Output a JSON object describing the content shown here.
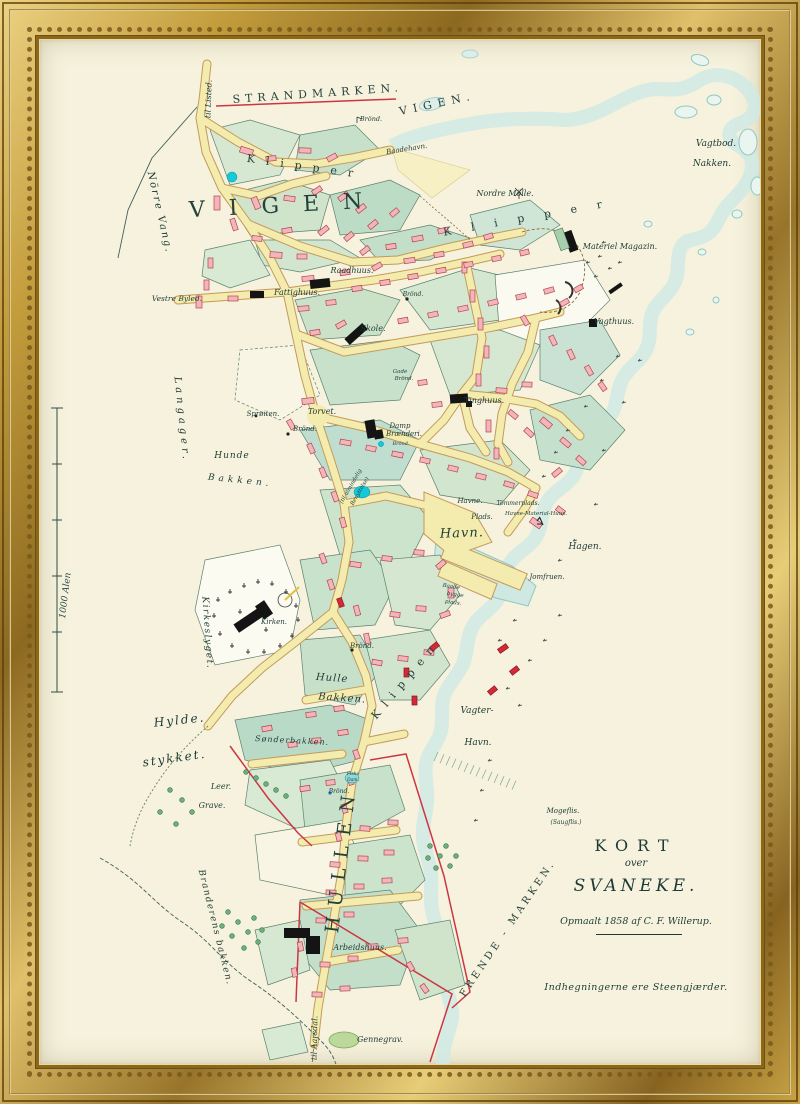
{
  "artwork": {
    "kind": "framed antique town map",
    "colors": {
      "frame_gold": "#c9a344",
      "paper": "#f6f2dd",
      "water": "#8fc9c3",
      "road_yellow": "#f3ecae",
      "parcel_green": "#cfe4cb",
      "building_pink": "#f2b6ba",
      "boundary_red": "#cc3644",
      "ink": "#1d3a35"
    },
    "title_block": {
      "kort": "KORT",
      "over": "over",
      "svaneke": "SVANEKE.",
      "surveyed": "Opmaalt 1858 af C. F. Willerup.",
      "note": "Indhegningerne ere Steengjærder."
    },
    "scale_bar": {
      "label": "1000 Alen"
    },
    "labels": [
      {
        "t": "STRANDMARKEN.",
        "x": 318,
        "y": 97,
        "r": -4,
        "s": 11,
        "sp": 5,
        "c": "a"
      },
      {
        "t": "Klipper",
        "x": 305,
        "y": 170,
        "r": 8,
        "s": 11,
        "sp": 11,
        "c": "a"
      },
      {
        "t": "VIGEN.",
        "x": 438,
        "y": 107,
        "r": -12,
        "s": 11,
        "sp": 6,
        "c": "a"
      },
      {
        "t": "VIGEN",
        "x": 288,
        "y": 212,
        "r": -3,
        "s": 22,
        "sp": 24,
        "c": "a"
      },
      {
        "t": "Klipper",
        "x": 533,
        "y": 220,
        "r": -10,
        "s": 11,
        "sp": 20,
        "c": "a"
      },
      {
        "t": "Klippen",
        "x": 408,
        "y": 682,
        "r": -50,
        "s": 11,
        "sp": 8,
        "c": "a"
      },
      {
        "t": "FRENDE - MARKEN.",
        "x": 510,
        "y": 930,
        "r": -56,
        "s": 10,
        "sp": 3.5,
        "c": "a"
      },
      {
        "t": "HULLEN",
        "x": 347,
        "y": 860,
        "r": -83,
        "s": 19,
        "sp": 10,
        "c": "a"
      },
      {
        "t": "Hylde.",
        "x": 180,
        "y": 724,
        "r": -6,
        "s": 12,
        "sp": 2,
        "c": "b"
      },
      {
        "t": "stykket.",
        "x": 175,
        "y": 762,
        "r": -8,
        "s": 12,
        "sp": 2,
        "c": "b"
      },
      {
        "t": "Nörre Vang.",
        "x": 157,
        "y": 213,
        "r": 77,
        "s": 10,
        "sp": 2,
        "c": "b"
      },
      {
        "t": "Langager.",
        "x": 179,
        "y": 420,
        "r": 84,
        "s": 10,
        "sp": 4,
        "c": "b"
      },
      {
        "t": "Kirkeslyget.",
        "x": 205,
        "y": 633,
        "r": 86,
        "s": 9,
        "sp": 1.5,
        "c": "b"
      },
      {
        "t": "Branderens bakken.",
        "x": 213,
        "y": 928,
        "r": 76,
        "s": 9,
        "sp": 1.5,
        "c": "b"
      },
      {
        "t": "til Listed.",
        "x": 211,
        "y": 99,
        "r": -88,
        "s": 8,
        "sp": 0,
        "c": "b"
      },
      {
        "t": "til Aarsdal.",
        "x": 317,
        "y": 1038,
        "r": -89,
        "s": 8,
        "sp": 0,
        "c": "b"
      },
      {
        "t": "Hunde",
        "x": 232,
        "y": 458,
        "r": 0,
        "s": 9,
        "sp": 1,
        "c": "b"
      },
      {
        "t": "Bakken.",
        "x": 240,
        "y": 483,
        "r": 6,
        "s": 9,
        "sp": 4,
        "c": "b"
      },
      {
        "t": "Hulle",
        "x": 332,
        "y": 681,
        "r": 4,
        "s": 10,
        "sp": 1,
        "c": "b"
      },
      {
        "t": "Bakken.",
        "x": 342,
        "y": 701,
        "r": 4,
        "s": 10,
        "sp": 1,
        "c": "b"
      },
      {
        "t": "Vagter-",
        "x": 477,
        "y": 713,
        "r": 0,
        "s": 9,
        "sp": 0,
        "c": "b"
      },
      {
        "t": "Havn.",
        "x": 478,
        "y": 745,
        "r": 0,
        "s": 9,
        "sp": 0,
        "c": "b"
      },
      {
        "t": "Vagtbod.",
        "x": 716,
        "y": 146,
        "r": 0,
        "s": 9,
        "sp": 0,
        "c": "b"
      },
      {
        "t": "Nakken.",
        "x": 712,
        "y": 166,
        "r": 0,
        "s": 9,
        "sp": 0,
        "c": "b"
      },
      {
        "t": "Havn.",
        "x": 462,
        "y": 537,
        "r": -2,
        "s": 13,
        "sp": 1,
        "c": "b"
      },
      {
        "t": "Hagen.",
        "x": 585,
        "y": 549,
        "r": 0,
        "s": 9,
        "sp": 0,
        "c": "b"
      },
      {
        "t": "Brönd.",
        "x": 371,
        "y": 121,
        "r": 0,
        "s": 6.5,
        "sp": 0,
        "c": "pl"
      },
      {
        "t": "Baadehavn.",
        "x": 407,
        "y": 151,
        "r": -9,
        "s": 7,
        "sp": 0,
        "c": "pl"
      },
      {
        "t": "Nordre Mölle.",
        "x": 505,
        "y": 196,
        "r": 0,
        "s": 8,
        "sp": 0,
        "c": "pl"
      },
      {
        "t": "Materiel Magazin.",
        "x": 620,
        "y": 249,
        "r": 0,
        "s": 8,
        "sp": 0,
        "c": "pl"
      },
      {
        "t": "Vagthuus.",
        "x": 614,
        "y": 324,
        "r": 0,
        "s": 8,
        "sp": 0,
        "c": "pl"
      },
      {
        "t": "Raadhuus.",
        "x": 352,
        "y": 273,
        "r": 0,
        "s": 8,
        "sp": 0,
        "c": "pl"
      },
      {
        "t": "Fattighuus.",
        "x": 297,
        "y": 295,
        "r": 0,
        "s": 8,
        "sp": 0,
        "c": "pl"
      },
      {
        "t": "Vestre Byled.",
        "x": 177,
        "y": 301,
        "r": 0,
        "s": 7.5,
        "sp": 0,
        "c": "pl"
      },
      {
        "t": "Skole.",
        "x": 373,
        "y": 331,
        "r": 0,
        "s": 8,
        "sp": 0,
        "c": "pl"
      },
      {
        "t": "Brönd.",
        "x": 413,
        "y": 296,
        "r": 0,
        "s": 6,
        "sp": 0,
        "c": "pl"
      },
      {
        "t": "Gade",
        "x": 400,
        "y": 373,
        "r": 0,
        "s": 5.5,
        "sp": 0,
        "c": "pl"
      },
      {
        "t": "Brönd.",
        "x": 404,
        "y": 380,
        "r": 0,
        "s": 5.5,
        "sp": 0,
        "c": "pl"
      },
      {
        "t": "Tinghuus.",
        "x": 484,
        "y": 403,
        "r": 0,
        "s": 8,
        "sp": 0,
        "c": "pl"
      },
      {
        "t": "Sprøiten.",
        "x": 263,
        "y": 416,
        "r": 0,
        "s": 7,
        "sp": 0,
        "c": "pl"
      },
      {
        "t": "Brönd.",
        "x": 305,
        "y": 431,
        "r": 0,
        "s": 7,
        "sp": 0,
        "c": "pl"
      },
      {
        "t": "Torvet.",
        "x": 322,
        "y": 414,
        "r": 0,
        "s": 8,
        "sp": 0,
        "c": "pl"
      },
      {
        "t": "Damp",
        "x": 400,
        "y": 428,
        "r": 0,
        "s": 7,
        "sp": 0,
        "c": "pl"
      },
      {
        "t": "Brænderi.",
        "x": 404,
        "y": 436,
        "r": 0,
        "s": 7,
        "sp": 0,
        "c": "pl"
      },
      {
        "t": "Brönd.",
        "x": 401,
        "y": 445,
        "r": 0,
        "s": 5,
        "sp": 0,
        "c": "pl"
      },
      {
        "t": "(til almindelig",
        "x": 352,
        "y": 487,
        "r": -60,
        "s": 5.5,
        "sp": 0,
        "c": "pl"
      },
      {
        "t": "Benyttelse)",
        "x": 361,
        "y": 492,
        "r": -60,
        "s": 5.5,
        "sp": 0,
        "c": "pl"
      },
      {
        "t": "Havne.",
        "x": 470,
        "y": 503,
        "r": 0,
        "s": 7,
        "sp": 0,
        "c": "pl"
      },
      {
        "t": "Plads.",
        "x": 482,
        "y": 519,
        "r": 0,
        "s": 7,
        "sp": 0,
        "c": "pl"
      },
      {
        "t": "Tömmerplads.",
        "x": 518,
        "y": 505,
        "r": 0,
        "s": 6,
        "sp": 0,
        "c": "pl"
      },
      {
        "t": "Havne-Material-Huus.",
        "x": 536,
        "y": 515,
        "r": 0,
        "s": 5.5,
        "sp": 0,
        "c": "pl"
      },
      {
        "t": "Jomfruen.",
        "x": 547,
        "y": 579,
        "r": 0,
        "s": 7,
        "sp": 0,
        "c": "pl"
      },
      {
        "t": "Baade",
        "x": 451,
        "y": 588,
        "r": 8,
        "s": 5.5,
        "sp": 0,
        "c": "pl"
      },
      {
        "t": "bygge",
        "x": 455,
        "y": 596,
        "r": 8,
        "s": 5.5,
        "sp": 0,
        "c": "pl"
      },
      {
        "t": "plads.",
        "x": 453,
        "y": 604,
        "r": 8,
        "s": 5.5,
        "sp": 0,
        "c": "pl"
      },
      {
        "t": "Brönd.",
        "x": 362,
        "y": 648,
        "r": 0,
        "s": 7,
        "sp": 0,
        "c": "pl"
      },
      {
        "t": "Kirken.",
        "x": 274,
        "y": 624,
        "r": 0,
        "s": 7,
        "sp": 0,
        "c": "pl"
      },
      {
        "t": "Sønderbakken.",
        "x": 292,
        "y": 743,
        "r": 3,
        "s": 8,
        "sp": 1,
        "c": "pl"
      },
      {
        "t": "Leer.",
        "x": 221,
        "y": 789,
        "r": 0,
        "s": 8,
        "sp": 0,
        "c": "pl"
      },
      {
        "t": "Grave.",
        "x": 212,
        "y": 808,
        "r": 0,
        "s": 8,
        "sp": 0,
        "c": "pl"
      },
      {
        "t": "Fiske",
        "x": 353,
        "y": 775,
        "r": 0,
        "s": 4.5,
        "sp": 0,
        "c": "pl"
      },
      {
        "t": "Dam.",
        "x": 353,
        "y": 781,
        "r": 0,
        "s": 4.5,
        "sp": 0,
        "c": "pl"
      },
      {
        "t": "Brönd.",
        "x": 339,
        "y": 793,
        "r": 0,
        "s": 6,
        "sp": 0,
        "c": "pl"
      },
      {
        "t": "Arbeidshuus.",
        "x": 360,
        "y": 950,
        "r": 0,
        "s": 8,
        "sp": 0,
        "c": "pl"
      },
      {
        "t": "Gennegrav.",
        "x": 380,
        "y": 1042,
        "r": 0,
        "s": 8,
        "sp": 0,
        "c": "pl"
      },
      {
        "t": "Mogeflis.",
        "x": 563,
        "y": 813,
        "r": 0,
        "s": 7,
        "sp": 0,
        "c": "pl"
      },
      {
        "t": "(Saugflis.)",
        "x": 566,
        "y": 824,
        "r": 0,
        "s": 6,
        "sp": 0,
        "c": "pl"
      }
    ]
  }
}
